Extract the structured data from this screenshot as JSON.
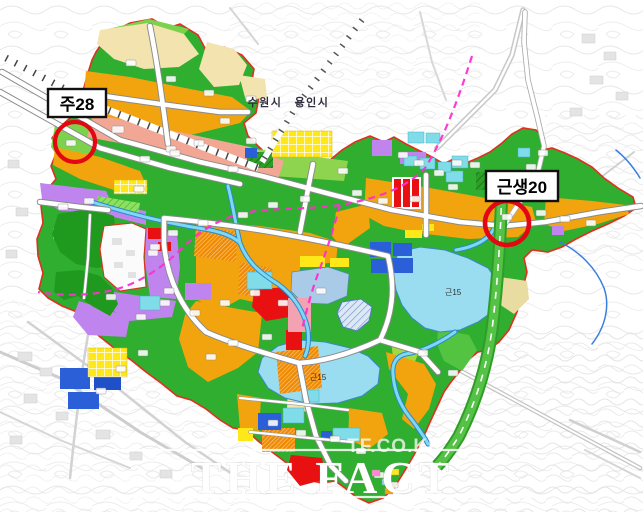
{
  "callouts": [
    {
      "id": "ju28",
      "label": "주28"
    },
    {
      "id": "geunsaeng20",
      "label": "근생20"
    }
  ],
  "city_labels": {
    "left": "수원시",
    "right": "용인시"
  },
  "zone_labels": {
    "east_lake": "근15",
    "south_lake": "근15"
  },
  "watermark": {
    "site": "TF.CO.KR",
    "brand": "THE FACT"
  },
  "colors": {
    "district_boundary": "#e03020",
    "park_green": "#2fae2f",
    "light_green": "#7cd24c",
    "residential_orange": "#f2a40e",
    "cream": "#f3e3ae",
    "salmon": "#f2a694",
    "purple": "#bf84ee",
    "commercial_red": "#e81010",
    "school_blue": "#2a5fd8",
    "powder_blue": "#a9cbe8",
    "cyan": "#7fdce8",
    "yellow": "#ffe81a",
    "lake_blue": "#9adcf0",
    "stream_blue": "#7fd8f0",
    "planned_line_pink": "#ff2fd0",
    "annotation_red": "#e30613"
  }
}
